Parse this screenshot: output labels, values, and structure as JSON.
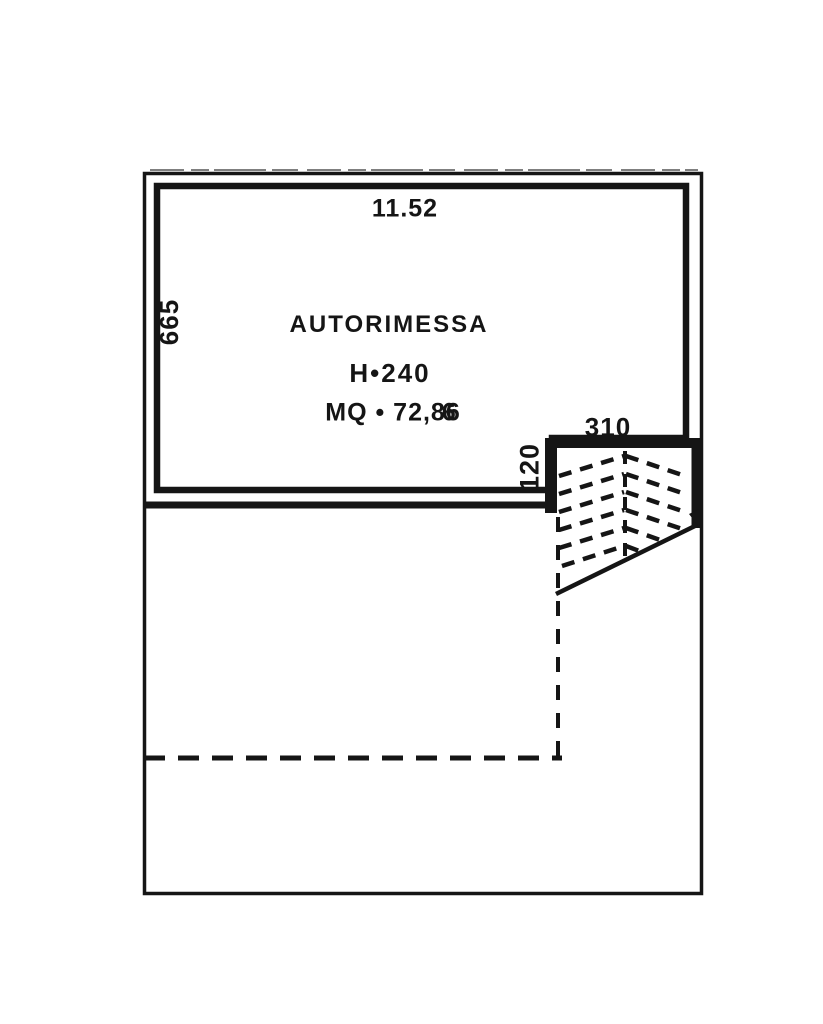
{
  "colors": {
    "ink": "#151515",
    "paper": "#ffffff"
  },
  "plan": {
    "room": {
      "name": "AUTORIMESSA",
      "height_label": "H•240",
      "area_label_main": "MQ • 72,8",
      "area_label_overstruck_digit": "6"
    },
    "dimensions": {
      "top_width": "11.52",
      "left_height": "665",
      "ramp_width": "310",
      "ramp_depth": "120"
    }
  }
}
